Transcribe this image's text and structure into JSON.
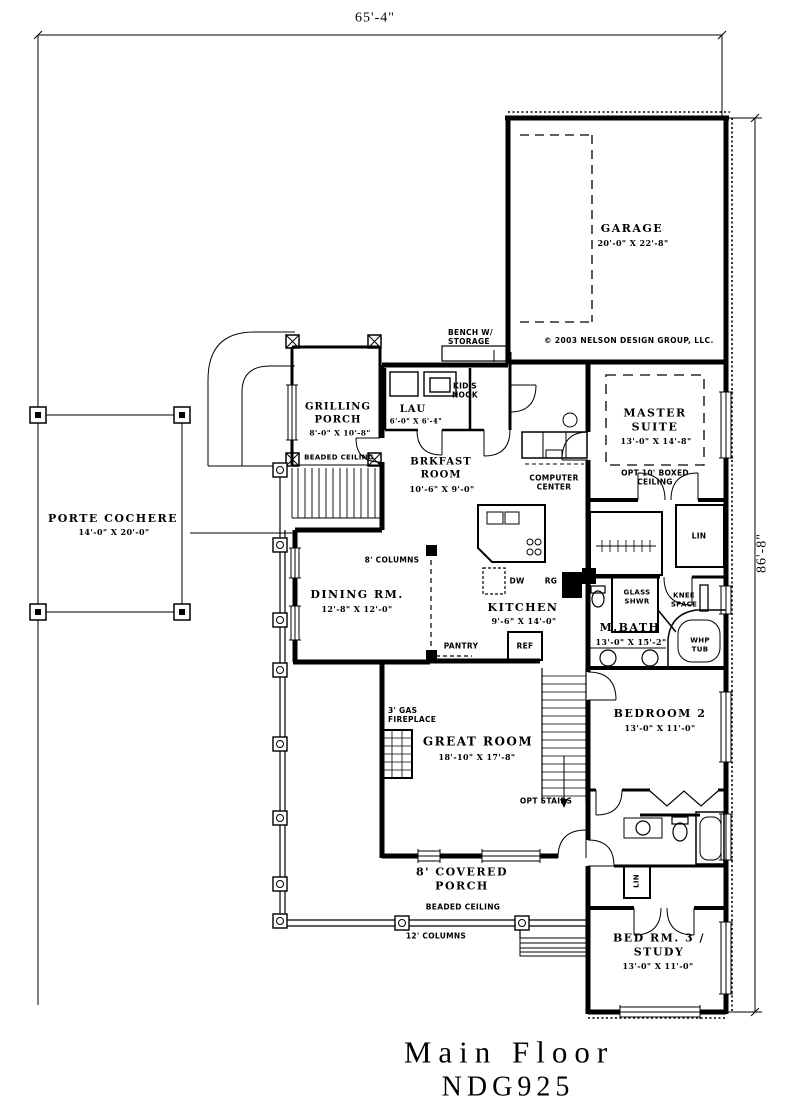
{
  "dimensions": {
    "top": "65'-4\"",
    "right": "86'-8\""
  },
  "copyright_notice": "© 2003 NELSON DESIGN GROUP, LLC.",
  "title": {
    "main": "Main Floor",
    "plan_number": "NDG925"
  },
  "rooms": {
    "garage": {
      "name": "GARAGE",
      "dims": "20'-0\" X 22'-8\""
    },
    "master_suite": {
      "name": "MASTER SUITE",
      "dims": "13'-0\" X 14'-8\"",
      "note": "OPT 10' BOXED CEILING"
    },
    "grilling_porch": {
      "name": "GRILLING PORCH",
      "dims": "8'-0\" X 10'-8\"",
      "note": "BEADED CEILING"
    },
    "laundry": {
      "name": "LAU",
      "dims": "6'-0\" X 6'-4\""
    },
    "brkfast_room": {
      "name": "BRKFAST ROOM",
      "dims": "10'-6\" X 9'-0\""
    },
    "porte_cochere": {
      "name": "PORTE COCHERE",
      "dims": "14'-0\" X 20'-0\""
    },
    "dining_room": {
      "name": "DINING RM.",
      "dims": "12'-8\" X 12'-0\""
    },
    "kitchen": {
      "name": "KITCHEN",
      "dims": "9'-6\" X 14'-0\""
    },
    "master_bath": {
      "name": "M.BATH",
      "dims": "13'-0\" X 15'-2\""
    },
    "bedroom_2": {
      "name": "BEDROOM 2",
      "dims": "13'-0\" X 11'-0\""
    },
    "great_room": {
      "name": "GREAT ROOM",
      "dims": "18'-10\" X 17'-8\""
    },
    "covered_porch": {
      "name": "8' COVERED PORCH",
      "note": "BEADED CEILING"
    },
    "bed_room_3": {
      "name": "BED RM. 3 / STUDY",
      "dims": "13'-0\" X 11'-0\""
    }
  },
  "features": {
    "bench_storage": "BENCH W/ STORAGE",
    "kids_nook": "KID'S NOOK",
    "computer_center": "COMPUTER CENTER",
    "columns_8": "8' COLUMNS",
    "columns_12": "12' COLUMNS",
    "pantry": "PANTRY",
    "refrigerator": "REF",
    "dishwasher": "DW",
    "range": "RG",
    "linen": "LIN",
    "glass_shower": "GLASS SHWR",
    "knee_space": "KNEE SPACE",
    "whirlpool_tub": "WHP TUB",
    "fireplace": "3' GAS FIREPLACE",
    "opt_stairs": "OPT STAIRS"
  }
}
